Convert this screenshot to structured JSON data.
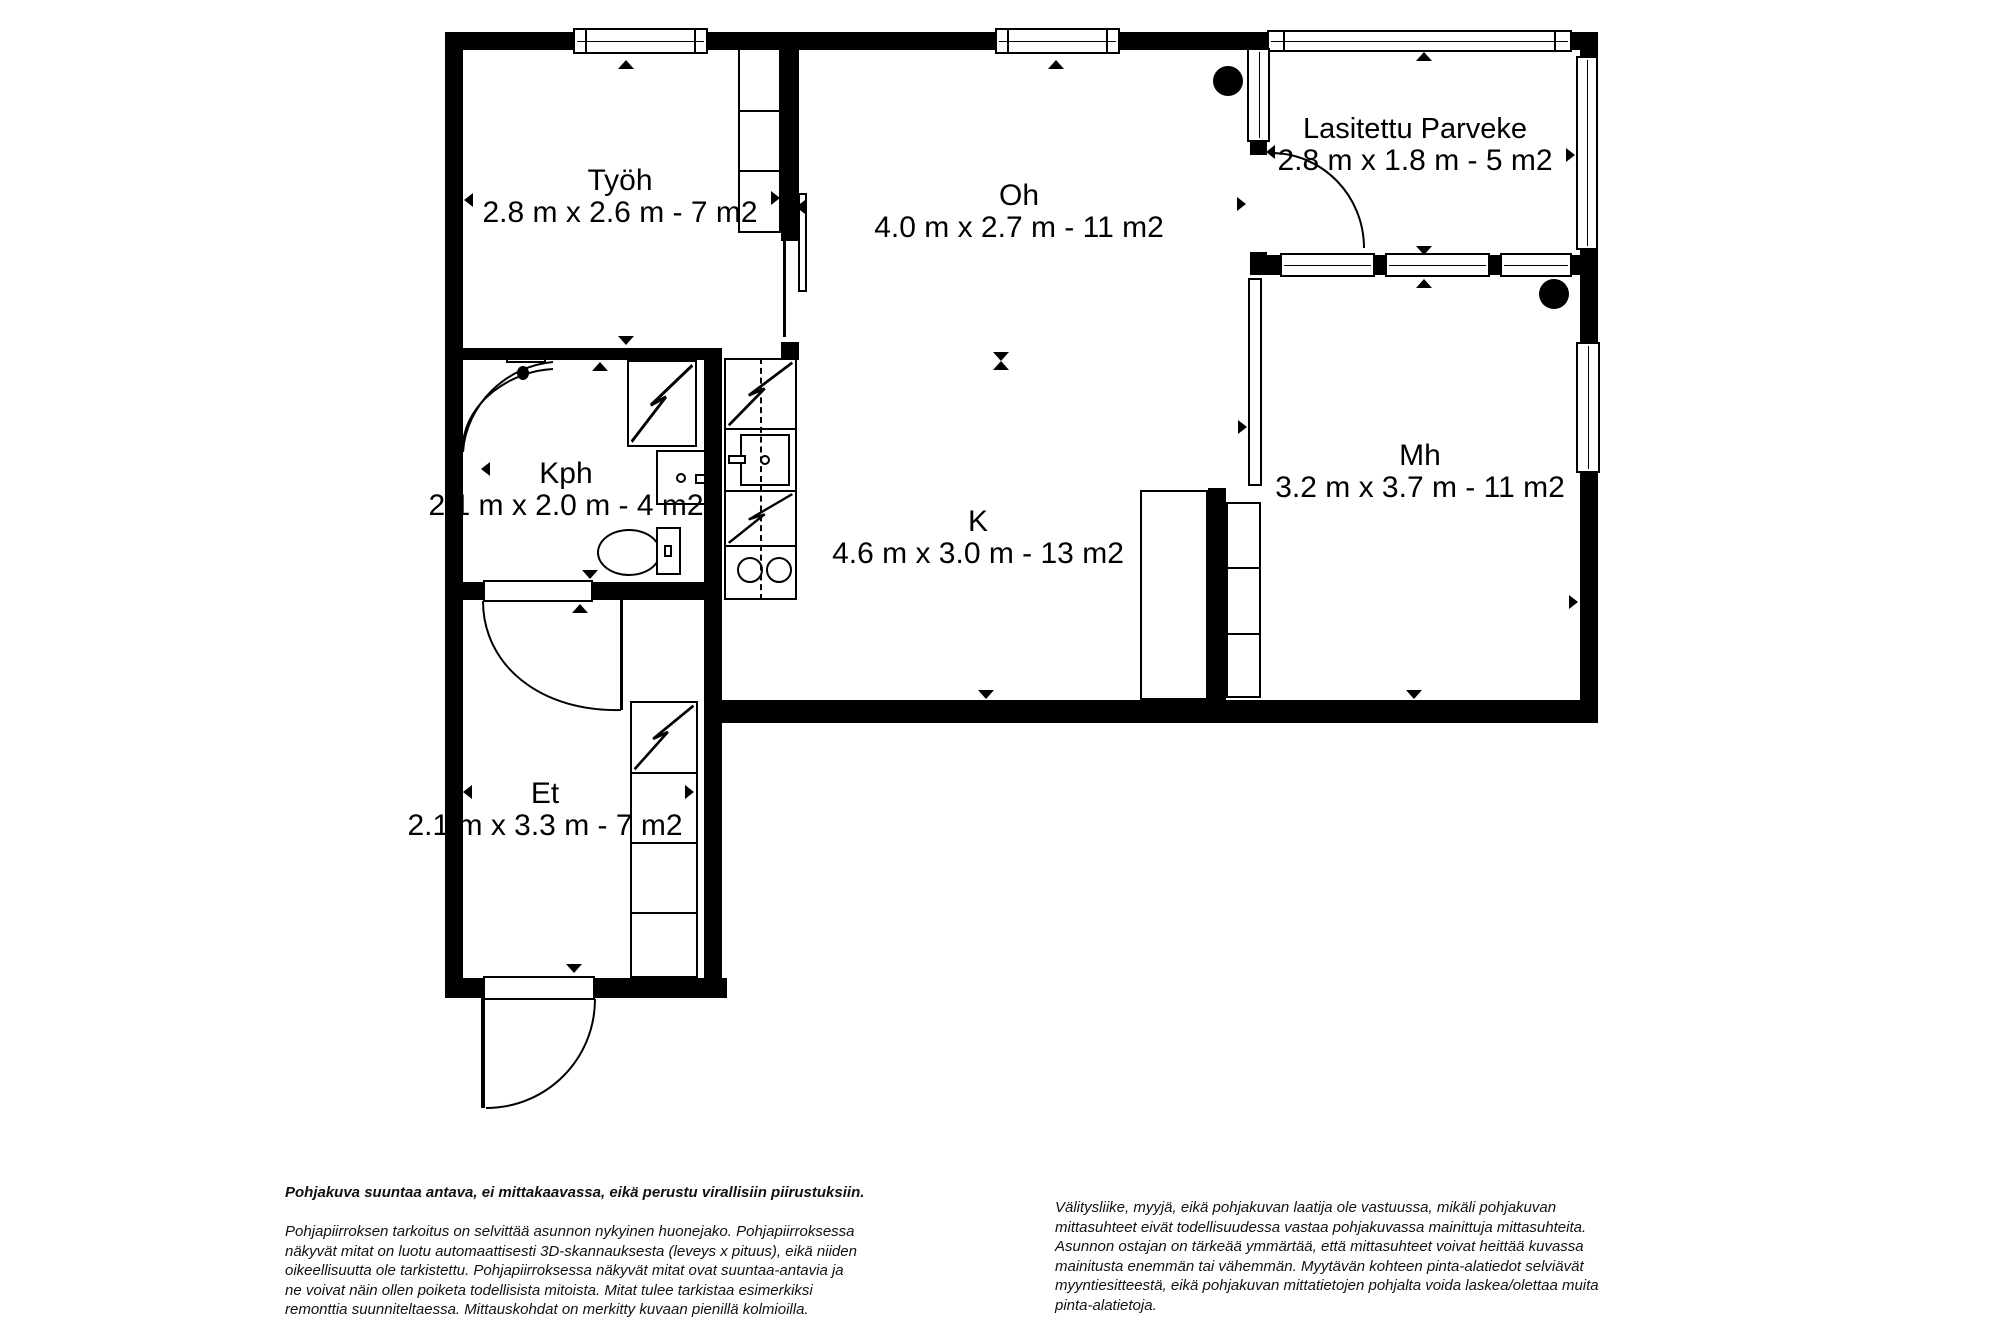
{
  "floorplan": {
    "rooms": [
      {
        "name": "Työh",
        "dims": "2.8 m x 2.6 m - 7 m2"
      },
      {
        "name": "Oh",
        "dims": "4.0 m x 2.7 m - 11 m2"
      },
      {
        "name": "Lasitettu Parveke",
        "dims": "2.8 m x 1.8 m - 5 m2"
      },
      {
        "name": "Kph",
        "dims": "2.1 m x 2.0 m - 4 m2"
      },
      {
        "name": "K",
        "dims": "4.6 m x 3.0 m - 13 m2"
      },
      {
        "name": "Mh",
        "dims": "3.2 m x 3.7 m - 11 m2"
      },
      {
        "name": "Et",
        "dims": "2.1 m x 3.3 m - 7 m2"
      }
    ],
    "colors": {
      "wall": "#000000",
      "floor": "#ffffff"
    }
  },
  "disclaimer": {
    "left_bold": "Pohjakuva suuntaa antava, ei mittakaavassa, eikä perustu virallisiin piirustuksiin.",
    "left_lines": [
      "Pohjapiirroksen tarkoitus on selvittää asunnon nykyinen huonejako. Pohjapiirroksessa",
      "näkyvät mitat on luotu automaattisesti 3D-skannauksesta (leveys x pituus), eikä niiden",
      "oikeellisuutta ole tarkistettu. Pohjapiirroksessa näkyvät mitat ovat suuntaa-antavia ja",
      "ne voivat näin ollen poiketa todellisista mitoista. Mitat tulee tarkistaa esimerkiksi",
      "remonttia suunniteltaessa. Mittauskohdat on merkitty kuvaan pienillä kolmioilla."
    ],
    "right_lines": [
      "Välitysliike, myyjä, eikä pohjakuvan laatija ole vastuussa, mikäli pohjakuvan",
      "mittasuhteet eivät todellisuudessa vastaa pohjakuvassa mainittuja mittasuhteita.",
      "Asunnon ostajan on tärkeää ymmärtää, että mittasuhteet voivat heittää kuvassa",
      "mainitusta enemmän tai vähemmän. Myytävän kohteen pinta-alatiedot selviävät",
      "myyntiesitteestä, eikä pohjakuvan mittatietojen pohjalta voida laskea/olettaa muita",
      "pinta-alatietoja."
    ]
  }
}
